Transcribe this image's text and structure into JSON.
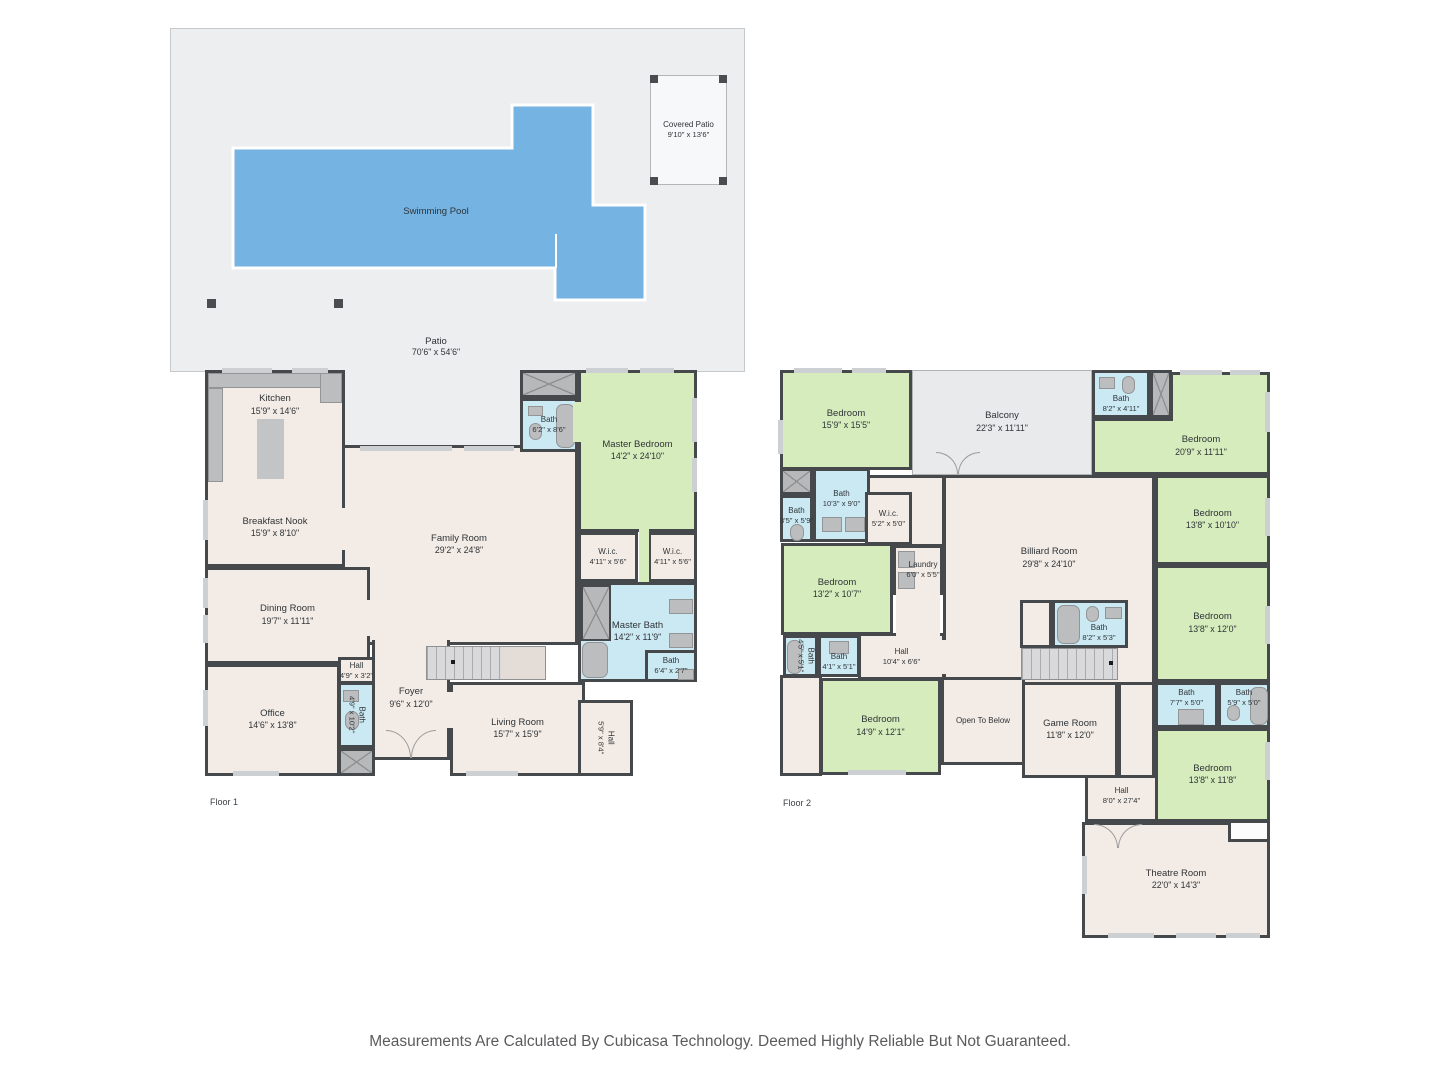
{
  "colors": {
    "wall": "#46494c",
    "room_beige": "#f3ebe5",
    "bedroom_green": "#d6ecbc",
    "bath_blue": "#cbe9f3",
    "pool_blue": "#74b3e2",
    "patio_gray": "#edeef0",
    "balcony_gray": "#e9eaec",
    "fixture_gray": "#bcbdbf"
  },
  "outdoor": {
    "swimming_pool": {
      "name": "Swimming Pool"
    },
    "patio": {
      "name": "Patio",
      "dims": "70'6\" x 54'6\""
    },
    "covered_patio": {
      "name": "Covered Patio",
      "dims": "9'10\" x 13'6\""
    }
  },
  "floor1": {
    "label": "Floor 1",
    "kitchen": {
      "name": "Kitchen",
      "dims": "15'9\" x 14'6\""
    },
    "breakfast_nook": {
      "name": "Breakfast Nook",
      "dims": "15'9\" x 8'10\""
    },
    "dining_room": {
      "name": "Dining Room",
      "dims": "19'7\" x 11'11\""
    },
    "office": {
      "name": "Office",
      "dims": "14'6\" x 13'8\""
    },
    "hall_small": {
      "name": "Hall",
      "dims": "4'9\" x 3'2\""
    },
    "bath_hall": {
      "name": "Bath",
      "dims": "4'9\" x 10'2\""
    },
    "foyer": {
      "name": "Foyer",
      "dims": "9'6\" x 12'0\""
    },
    "family_room": {
      "name": "Family Room",
      "dims": "29'2\" x 24'8\""
    },
    "living_room": {
      "name": "Living Room",
      "dims": "15'7\" x 15'9\""
    },
    "hall_side": {
      "name": "Hall",
      "dims": "5'9\" x 8'4\""
    },
    "bath_upper": {
      "name": "Bath",
      "dims": "6'2\" x 8'6\""
    },
    "master_bedroom": {
      "name": "Master Bedroom",
      "dims": "14'2\" x 24'10\""
    },
    "wic_left": {
      "name": "W.i.c.",
      "dims": "4'11\" x 5'6\""
    },
    "wic_right": {
      "name": "W.i.c.",
      "dims": "4'11\" x 5'6\""
    },
    "master_bath": {
      "name": "Master Bath",
      "dims": "14'2\" x 11'9\""
    },
    "bath_small": {
      "name": "Bath",
      "dims": "6'4\" x 2'7\""
    }
  },
  "floor2": {
    "label": "Floor 2",
    "bedroom_tl": {
      "name": "Bedroom",
      "dims": "15'9\" x 15'5\""
    },
    "balcony": {
      "name": "Balcony",
      "dims": "22'3\" x 11'11\""
    },
    "bath_top": {
      "name": "Bath",
      "dims": "8'2\" x 4'11\""
    },
    "bedroom_tr": {
      "name": "Bedroom",
      "dims": "20'9\" x 11'11\""
    },
    "bedroom_r1": {
      "name": "Bedroom",
      "dims": "13'8\" x 10'10\""
    },
    "bath_35": {
      "name": "Bath",
      "dims": "3'5\" x 5'9\""
    },
    "bath_103": {
      "name": "Bath",
      "dims": "10'3\" x 9'0\""
    },
    "wic": {
      "name": "W.i.c.",
      "dims": "5'2\" x 5'0\""
    },
    "billiard": {
      "name": "Billiard Room",
      "dims": "29'8\" x 24'10\""
    },
    "laundry": {
      "name": "Laundry",
      "dims": "6'0\" x 5'5\""
    },
    "bedroom_l2": {
      "name": "Bedroom",
      "dims": "13'2\" x 10'7\""
    },
    "bath_45": {
      "name": "Bath",
      "dims": "4'5\" x 5'1\""
    },
    "bath_41": {
      "name": "Bath",
      "dims": "4'1\" x 5'1\""
    },
    "hall_center": {
      "name": "Hall",
      "dims": "10'4\" x 6'6\""
    },
    "bedroom_l3": {
      "name": "Bedroom",
      "dims": "14'9\" x 12'1\""
    },
    "open_below": {
      "name": "Open To Below"
    },
    "bath_billiard": {
      "name": "Bath",
      "dims": "8'2\" x 5'3\""
    },
    "game_room": {
      "name": "Game Room",
      "dims": "11'8\" x 12'0\""
    },
    "bedroom_r2": {
      "name": "Bedroom",
      "dims": "13'8\" x 12'0\""
    },
    "bath_77": {
      "name": "Bath",
      "dims": "7'7\" x 5'0\""
    },
    "bath_59": {
      "name": "Bath",
      "dims": "5'9\" x 5'0\""
    },
    "bedroom_r3": {
      "name": "Bedroom",
      "dims": "13'8\" x 11'8\""
    },
    "hall_bottom": {
      "name": "Hall",
      "dims": "8'0\" x 27'4\""
    },
    "theatre": {
      "name": "Theatre Room",
      "dims": "22'0\" x 14'3\""
    }
  },
  "disclaimer": "Measurements Are Calculated By Cubicasa Technology. Deemed Highly Reliable But Not Guaranteed."
}
